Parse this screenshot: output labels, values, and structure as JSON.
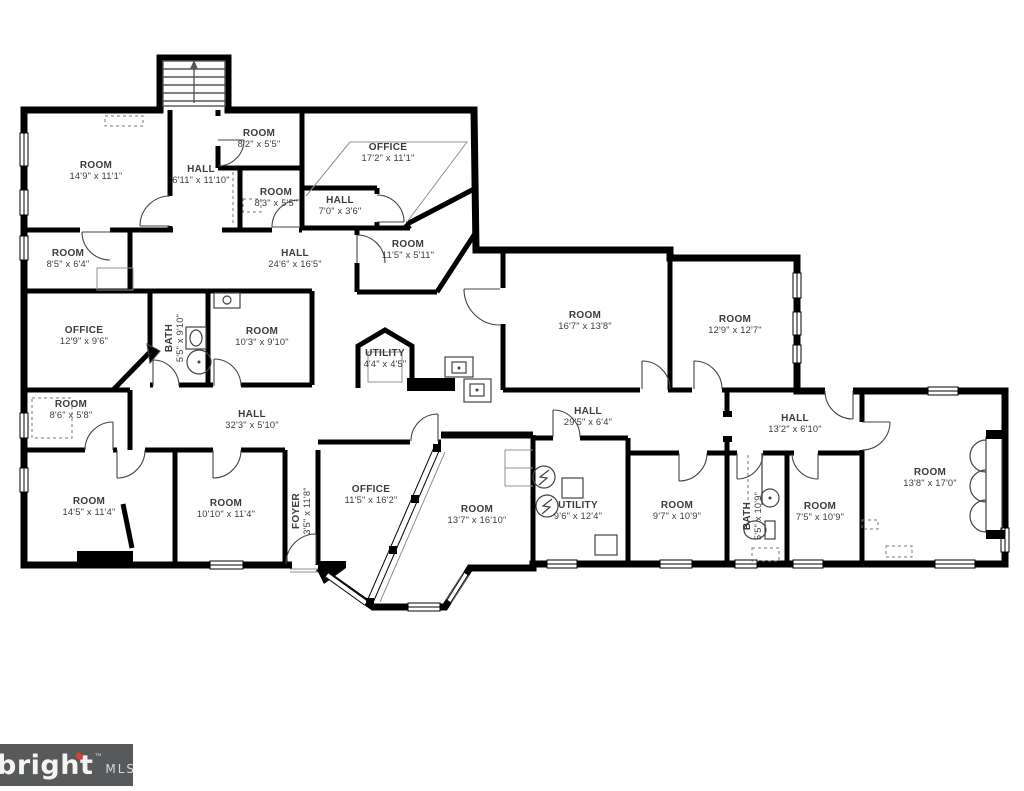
{
  "floorplan": {
    "rooms": [
      {
        "label": "ROOM",
        "dims": "14'9\" x 11'1\"",
        "x": 96,
        "y": 168,
        "rot": 0
      },
      {
        "label": "HALL",
        "dims": "6'11\" x 11'10\"",
        "x": 201,
        "y": 172,
        "rot": 0
      },
      {
        "label": "ROOM",
        "dims": "8'2\" x 5'5\"",
        "x": 259,
        "y": 136,
        "rot": 0
      },
      {
        "label": "ROOM",
        "dims": "8'3\" x 5'5\"",
        "x": 276,
        "y": 195,
        "rot": 0
      },
      {
        "label": "OFFICE",
        "dims": "17'2\" x 11'1\"",
        "x": 388,
        "y": 150,
        "rot": 0
      },
      {
        "label": "HALL",
        "dims": "7'0\" x 3'6\"",
        "x": 340,
        "y": 203,
        "rot": 0
      },
      {
        "label": "ROOM",
        "dims": "11'5\" x 5'11\"",
        "x": 408,
        "y": 247,
        "rot": 0
      },
      {
        "label": "ROOM",
        "dims": "8'5\" x 6'4\"",
        "x": 68,
        "y": 256,
        "rot": 0
      },
      {
        "label": "HALL",
        "dims": "24'6\" x 16'5\"",
        "x": 295,
        "y": 256,
        "rot": 0
      },
      {
        "label": "OFFICE",
        "dims": "12'9\" x 9'6\"",
        "x": 84,
        "y": 333,
        "rot": 0
      },
      {
        "label": "BATH",
        "dims": "5'5\" x 9'10\"",
        "x": 172,
        "y": 338,
        "rot": -90
      },
      {
        "label": "ROOM",
        "dims": "10'3\" x 9'10\"",
        "x": 262,
        "y": 334,
        "rot": 0
      },
      {
        "label": "UTILITY",
        "dims": "4'4\" x 4'5\"",
        "x": 385,
        "y": 356,
        "rot": 0
      },
      {
        "label": "ROOM",
        "dims": "16'7\" x 13'8\"",
        "x": 585,
        "y": 318,
        "rot": 0
      },
      {
        "label": "ROOM",
        "dims": "12'9\" x 12'7\"",
        "x": 735,
        "y": 322,
        "rot": 0
      },
      {
        "label": "ROOM",
        "dims": "8'6\" x 5'8\"",
        "x": 71,
        "y": 407,
        "rot": 0
      },
      {
        "label": "HALL",
        "dims": "32'3\" x 5'10\"",
        "x": 252,
        "y": 417,
        "rot": 0
      },
      {
        "label": "HALL",
        "dims": "29'5\" x 6'4\"",
        "x": 588,
        "y": 414,
        "rot": 0
      },
      {
        "label": "HALL",
        "dims": "13'2\" x 6'10\"",
        "x": 795,
        "y": 421,
        "rot": 0
      },
      {
        "label": "ROOM",
        "dims": "14'5\" x 11'4\"",
        "x": 89,
        "y": 504,
        "rot": 0
      },
      {
        "label": "ROOM",
        "dims": "10'10\" x 11'4\"",
        "x": 226,
        "y": 506,
        "rot": 0
      },
      {
        "label": "FOYER",
        "dims": "3'5\" x 11'8\"",
        "x": 299,
        "y": 511,
        "rot": -90
      },
      {
        "label": "OFFICE",
        "dims": "11'5\" x 16'2\"",
        "x": 371,
        "y": 492,
        "rot": 0
      },
      {
        "label": "ROOM",
        "dims": "13'7\" x 16'10\"",
        "x": 477,
        "y": 512,
        "rot": 0
      },
      {
        "label": "UTILITY",
        "dims": "9'6\" x 12'4\"",
        "x": 578,
        "y": 508,
        "rot": 0
      },
      {
        "label": "ROOM",
        "dims": "9'7\" x 10'9\"",
        "x": 677,
        "y": 508,
        "rot": 0
      },
      {
        "label": "BATH",
        "dims": "5'5\" x 10'9\"",
        "x": 750,
        "y": 516,
        "rot": -90
      },
      {
        "label": "ROOM",
        "dims": "7'5\" x 10'9\"",
        "x": 820,
        "y": 509,
        "rot": 0
      },
      {
        "label": "ROOM",
        "dims": "13'8\" x 17'0\"",
        "x": 930,
        "y": 475,
        "rot": 0
      }
    ]
  },
  "logo": {
    "brand": "bright",
    "tm": "™",
    "suffix": "MLS",
    "background": "#58595B",
    "accent": "#E03C31"
  },
  "colors": {
    "wall": "#000000",
    "label_text": "#3C3C3C",
    "background": "#FFFFFF"
  }
}
